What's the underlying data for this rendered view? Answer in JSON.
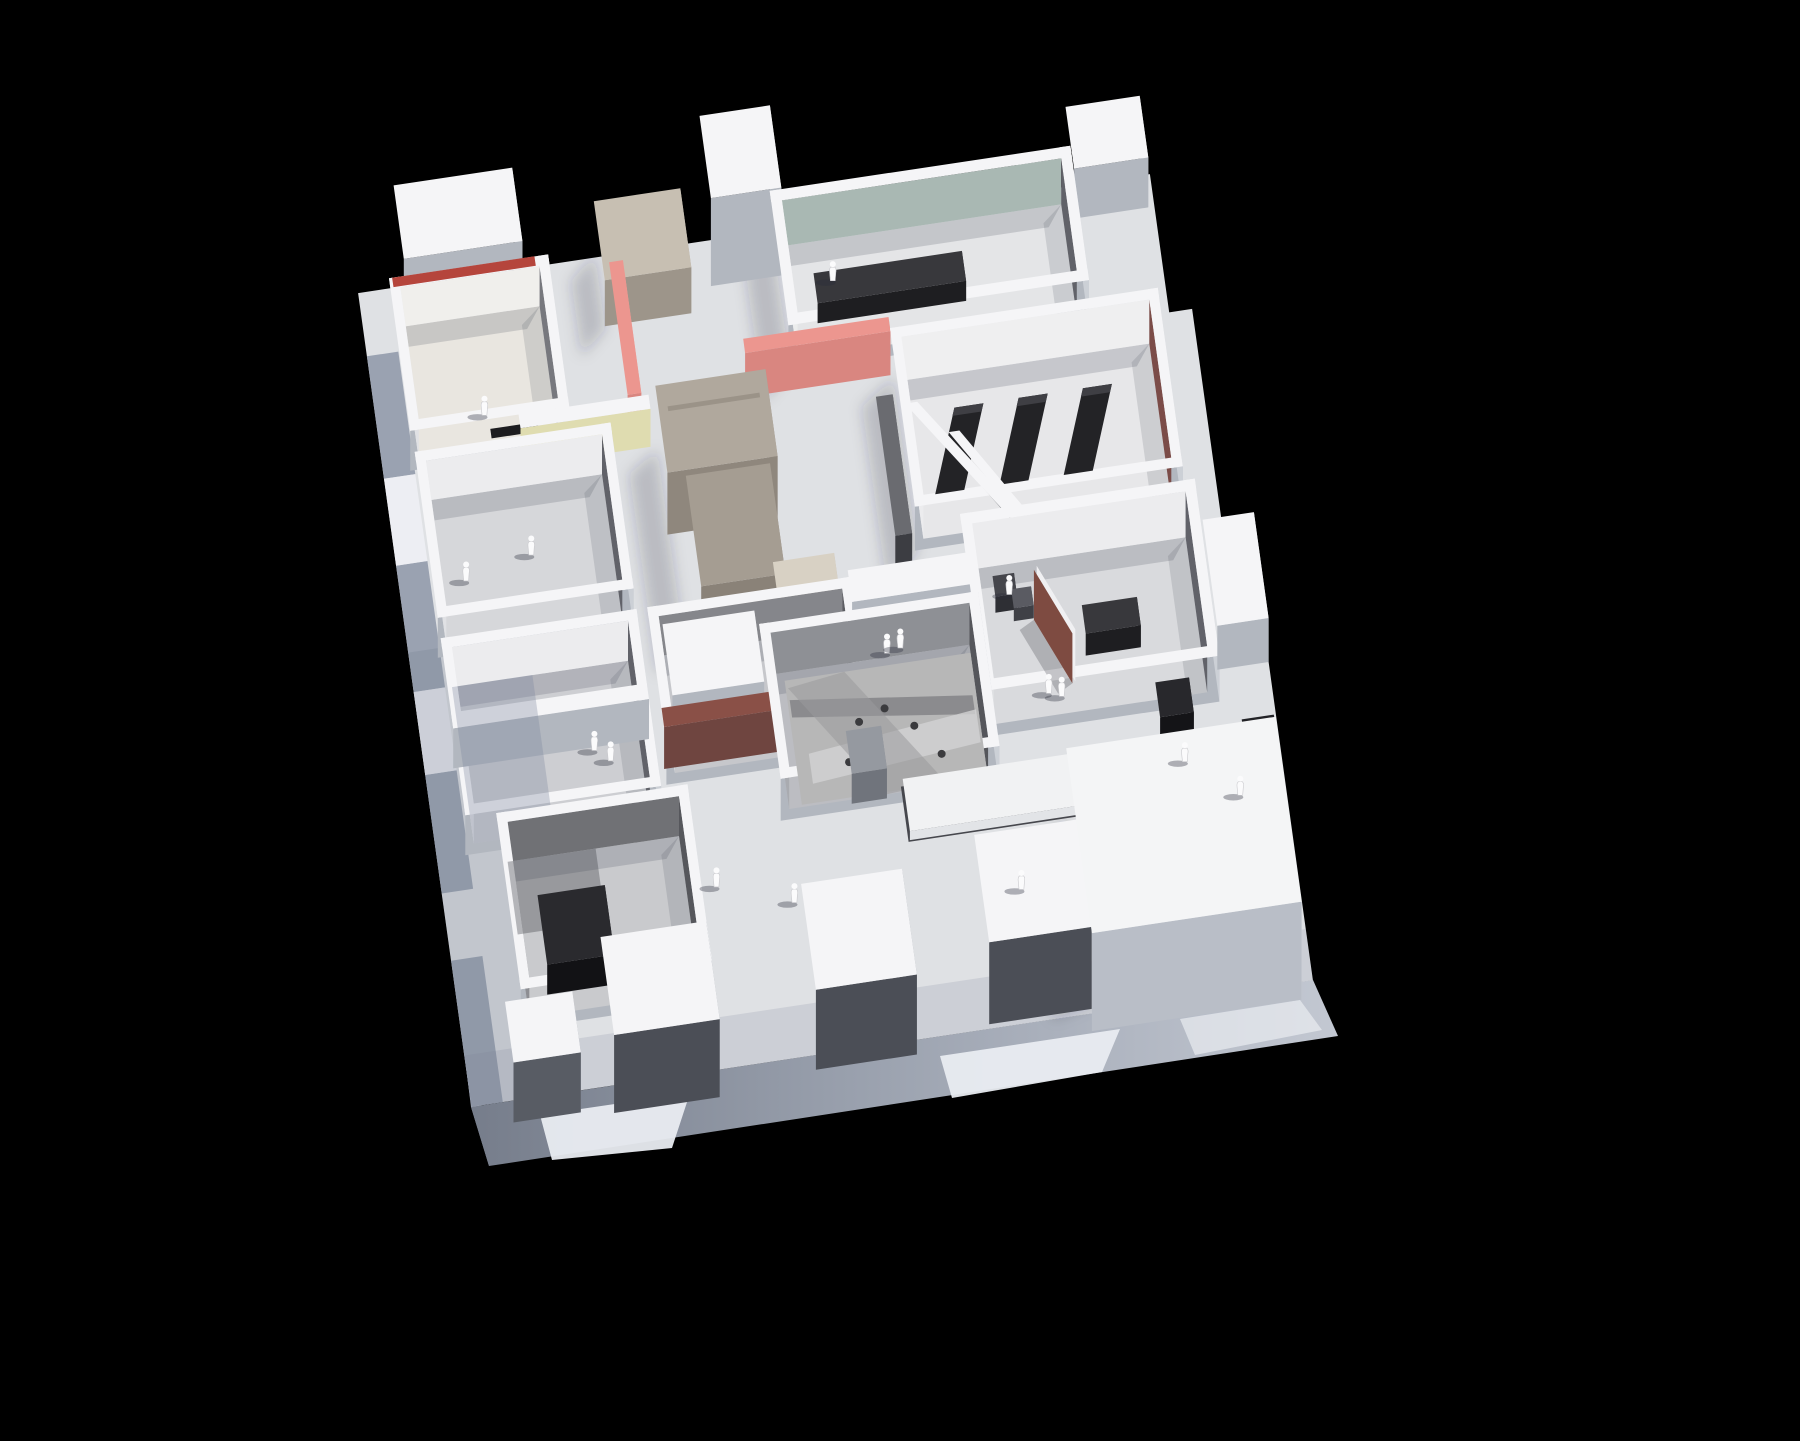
{
  "meta": {
    "domain": "photograph",
    "subject": "aerial view of a white architectural scale model of a museum / gallery floor plan on a black background"
  },
  "palette": {
    "background": "#000000",
    "plate": "#dfe1e4",
    "margin_blue": "#8e97a8",
    "margin_light": "#eef0f4",
    "plinth_left": "#a9b1c0",
    "plinth_front_a": "#7b8290",
    "plinth_front_b": "#c3c8d2",
    "plinth_patch": "#e9ecf1",
    "white_top": "#f5f5f7",
    "face_front": "#b2b7bf",
    "face_front_dark": "#4b4e56",
    "face_right": "#ccd0d6",
    "inner_dark": "#616269",
    "inner_mid": "#8e9095",
    "inner_light": "#ececee",
    "floor_room": "#d6d7da",
    "floor_warm": "#e9e6e0",
    "floor_cool": "#c9cacd",
    "teal": "#a9b8b3",
    "pink": "#ec968f",
    "pink_shade": "#d98680",
    "red_strip": "#b5453c",
    "maroon": "#7b4c48",
    "brick": "#8a5047",
    "panel_brown": "#7e4b41",
    "yellow": "#dfdcb0",
    "concrete": "#b0a89d",
    "concrete_side": "#8f877d",
    "beige_top": "#d8d1c4",
    "black_obj": "#232326",
    "black_deep": "#1c1c1f",
    "figure": "#fbfbfc",
    "photo_base": "#b7b7b7",
    "photo_dark": "#808083",
    "shadow_soft": "rgba(40,46,62,0.20)"
  },
  "scene": {
    "base": {
      "name": "base-plinth",
      "description": "thick white model base with blue-grey shadowed side faces and bright light patches"
    },
    "rooms": [
      {
        "name": "room-red-strip",
        "accent": "red_strip"
      },
      {
        "name": "room-teal-wall",
        "accent": "teal"
      },
      {
        "name": "room-maroon-benches",
        "accent": "maroon",
        "benches": 3
      },
      {
        "name": "room-upper-left-gallery",
        "accent": null
      },
      {
        "name": "room-brown-divider-panel",
        "accent": "panel_brown"
      },
      {
        "name": "room-photo-floor",
        "accent": "photo_base"
      },
      {
        "name": "room-brick-wall",
        "accent": "brick"
      },
      {
        "name": "room-black-box",
        "accent": "black_deep"
      },
      {
        "name": "room-left-pair",
        "accent": null
      }
    ],
    "features": [
      {
        "name": "pink-accent-wall-vertical",
        "color": "pink"
      },
      {
        "name": "pink-accent-wall-horizontal",
        "color": "pink"
      },
      {
        "name": "yellow-accent-wall",
        "color": "yellow"
      },
      {
        "name": "concrete-core-blocks",
        "color": "concrete"
      },
      {
        "name": "ramp-with-white-parapets",
        "color": "white_top"
      },
      {
        "name": "white-roof-blocks",
        "color": "white_top"
      },
      {
        "name": "white-exhibition-platform",
        "color": "white_top"
      },
      {
        "name": "black-display-benches",
        "color": "black_obj"
      }
    ],
    "figures": {
      "name": "visitor-figures",
      "count": 16,
      "color": "figure"
    }
  }
}
